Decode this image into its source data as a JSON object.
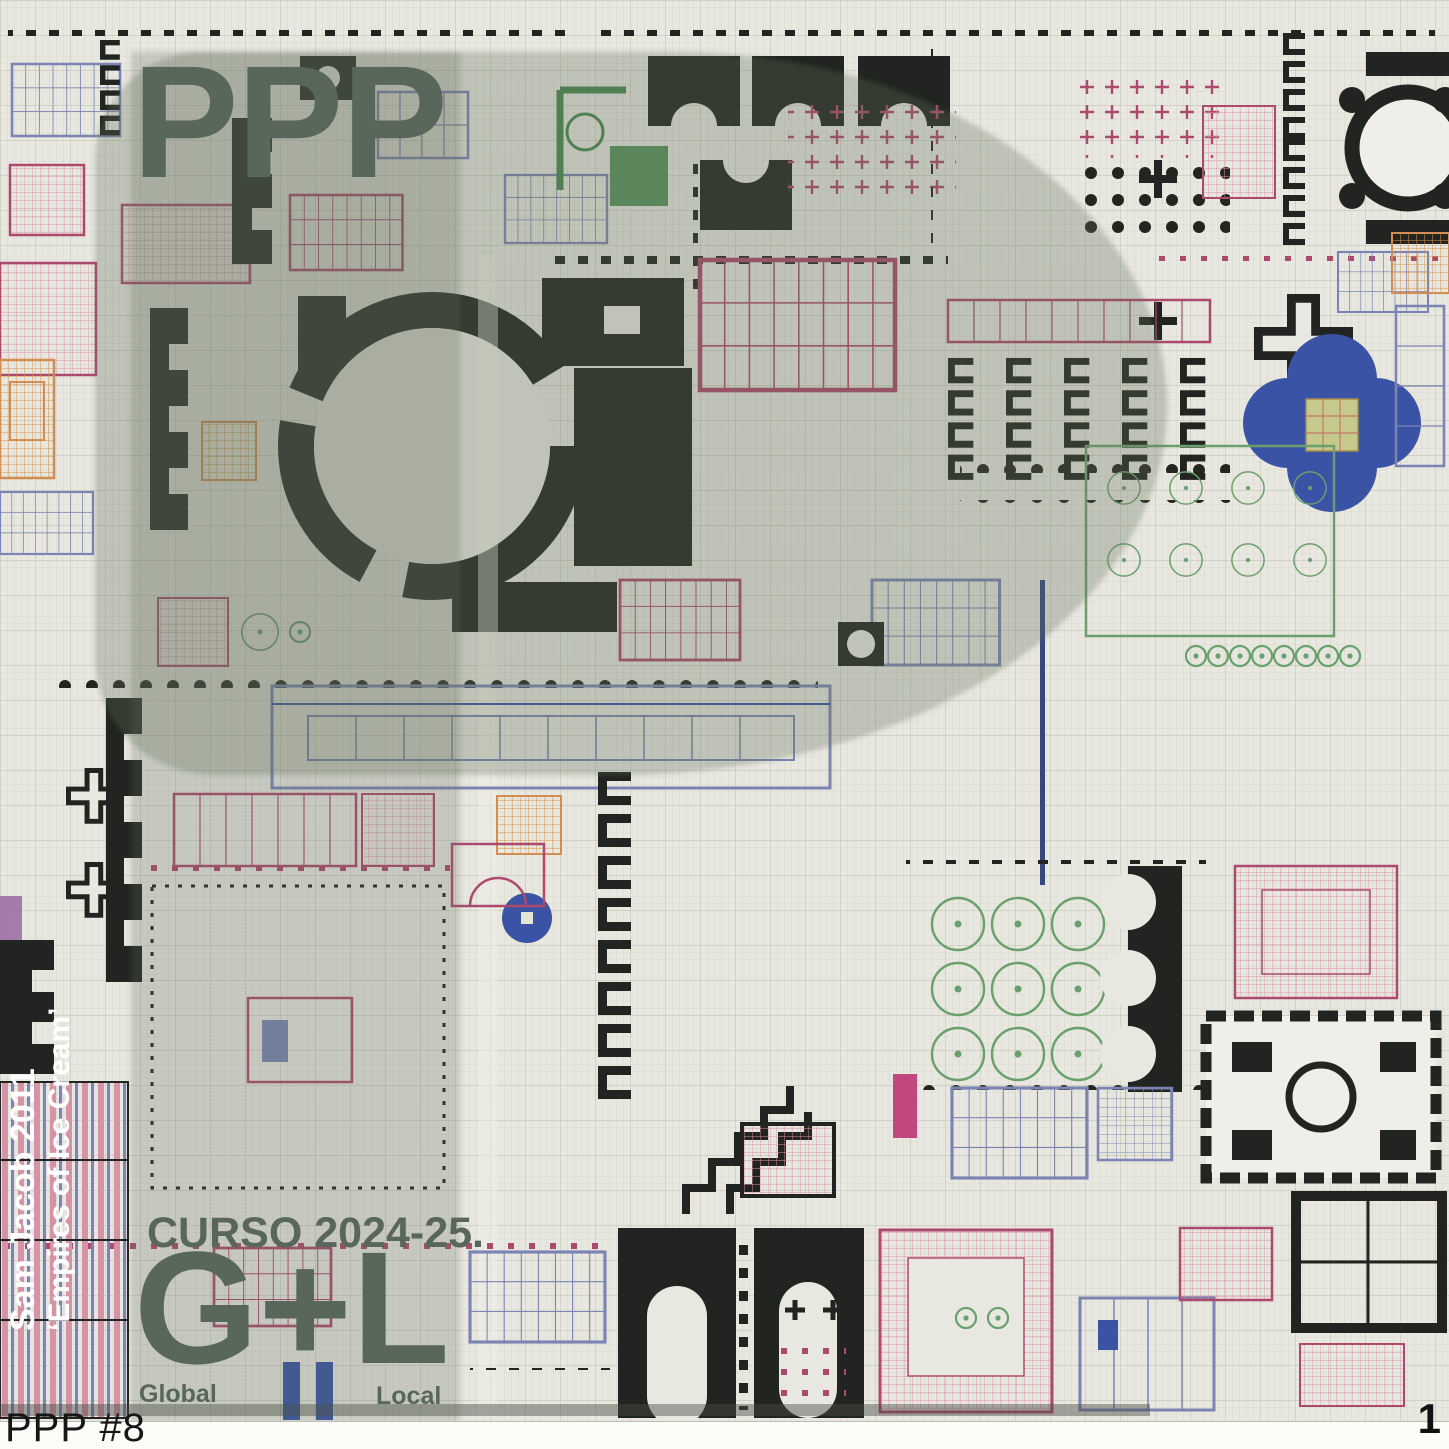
{
  "poster": {
    "watermark": "PPP",
    "course_label": "CURSO 2024-25.",
    "duality_acronym": "G+L",
    "global_label": "Global",
    "local_label": "Local",
    "credit_line1": "Sam Jacob 2011",
    "credit_line2": "‘Empires of Ice Cream’",
    "footer_id": "PPP #8",
    "page_number": "1",
    "colors": {
      "accent_sage": "#58675a",
      "credit_white": "#ffffff",
      "paper": "#e8e7e0",
      "overlay_tint": "rgba(100,112,90,0.30)",
      "plan_black": "#212420",
      "plan_crimson": "#ac4a6e",
      "plan_blue": "#3a53a4",
      "plan_green": "#6aa06d",
      "plan_orange": "#d28d52"
    }
  }
}
